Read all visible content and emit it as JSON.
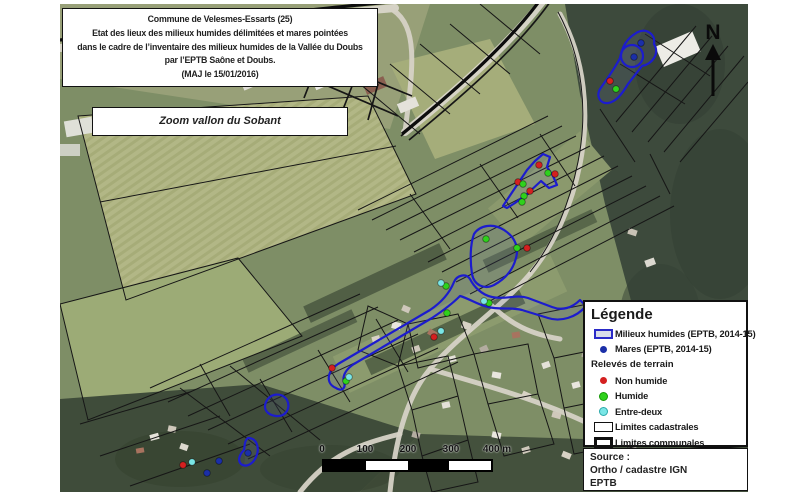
{
  "title_box": {
    "lines": [
      "Commune de Velesmes-Essarts (25)",
      "Etat des lieux des milieux humides délimitées et mares pointées",
      "dans le cadre de l’inventaire des milieux humides de la Vallée du Doubs",
      "par l’EPTB Saône et Doubs.",
      "(MAJ le 15/01/2016)"
    ]
  },
  "zoom_box": {
    "label": "Zoom vallon du Sobant"
  },
  "north_arrow": {
    "label": "N"
  },
  "scale_bar": {
    "tick_labels": [
      "0",
      "100",
      "200",
      "300",
      "400 m"
    ]
  },
  "legend": {
    "title": "Légende",
    "subheading": "Relevés de terrain",
    "items": [
      {
        "id": "milieux-humides",
        "label": "Milieux humides (EPTB, 2014-15)"
      },
      {
        "id": "mares",
        "label": "Mares (EPTB, 2014-15)"
      },
      {
        "id": "non-humide",
        "label": "Non humide"
      },
      {
        "id": "humide",
        "label": "Humide"
      },
      {
        "id": "entre-deux",
        "label": "Entre-deux"
      },
      {
        "id": "limites-cadastrales",
        "label": "Limites cadastrales"
      },
      {
        "id": "limites-communales",
        "label": "Limites communales"
      }
    ]
  },
  "source_box": {
    "lines": [
      "Source :",
      "Ortho / cadastre IGN",
      "EPTB"
    ]
  },
  "colors": {
    "mare": "#1b2fa8",
    "non_humide": "#d42020",
    "humide": "#2fd11c",
    "entre_deux": "#7ae6e6",
    "wetland_outline": "#1c1ccd",
    "cadastral_line": "#161616"
  },
  "map": {
    "wetlands": [
      {
        "name": "wetland-top-right",
        "path": "M578,28 C586,24 596,30 594,40 C600,50 592,60 582,62 L568,80 C562,90 556,98 548,99 C540,100 536,92 540,85 C546,76 554,66 560,54 C562,44 566,34 578,28 Z"
      },
      {
        "name": "wetland-top-right-ring",
        "path": "M561,52 a11,11 0 1 0 22,0 a11,11 0 1 0 -22,0"
      },
      {
        "name": "wetland-wedge",
        "path": "M443,202 L451,190 L459,178 L467,166 L475,157 L483,150 L490,153 L487,163 L493,172 L497,181 L489,184 L481,177 L467,190 L455,199 L447,204 Z"
      },
      {
        "name": "wetland-blob-mid",
        "path": "M414,230 C420,221 433,219 444,226 C455,233 459,243 456,254 C453,266 445,275 434,281 C424,286 414,281 412,270 C410,257 410,241 414,230 Z"
      },
      {
        "name": "wetland-vallon-ribbon",
        "path": "M276,384 C266,380 266,368 278,360 L370,306 C382,298 390,288 394,278 C397,271 406,269 410,275 C414,283 422,291 432,293 C446,296 456,290 468,294 L492,303 C502,307 512,304 520,296 L526,302 C516,314 500,318 488,314 L462,306 C450,303 440,306 428,303 C418,301 408,294 400,292 C394,298 384,306 372,314 L294,360 C286,365 282,372 284,378 C286,384 282,388 276,384 Z"
      },
      {
        "name": "wetland-small-blob",
        "path": "M206,398 C210,389 222,388 227,396 C231,404 226,413 216,412 C207,411 203,405 206,398 Z"
      },
      {
        "name": "wetland-comma",
        "path": "M188,434 C197,434 200,444 196,453 C193,460 186,464 181,460 C177,456 180,450 184,446 C185,442 184,437 188,434 Z"
      }
    ],
    "points": [
      {
        "type": "mare",
        "x": 581,
        "y": 39
      },
      {
        "type": "mare",
        "x": 574,
        "y": 53
      },
      {
        "type": "mare",
        "x": 159,
        "y": 457
      },
      {
        "type": "mare",
        "x": 147,
        "y": 469
      },
      {
        "type": "mare",
        "x": 188,
        "y": 449
      },
      {
        "type": "non_humide",
        "x": 550,
        "y": 77
      },
      {
        "type": "non_humide",
        "x": 479,
        "y": 161
      },
      {
        "type": "non_humide",
        "x": 495,
        "y": 170
      },
      {
        "type": "non_humide",
        "x": 458,
        "y": 178
      },
      {
        "type": "non_humide",
        "x": 470,
        "y": 187
      },
      {
        "type": "non_humide",
        "x": 374,
        "y": 333
      },
      {
        "type": "non_humide",
        "x": 272,
        "y": 364
      },
      {
        "type": "non_humide",
        "x": 123,
        "y": 461
      },
      {
        "type": "non_humide",
        "x": 467,
        "y": 244
      },
      {
        "type": "humide",
        "x": 556,
        "y": 85
      },
      {
        "type": "humide",
        "x": 488,
        "y": 169
      },
      {
        "type": "humide",
        "x": 463,
        "y": 180
      },
      {
        "type": "humide",
        "x": 464,
        "y": 192
      },
      {
        "type": "humide",
        "x": 462,
        "y": 198
      },
      {
        "type": "humide",
        "x": 386,
        "y": 282
      },
      {
        "type": "humide",
        "x": 429,
        "y": 299
      },
      {
        "type": "humide",
        "x": 387,
        "y": 309
      },
      {
        "type": "humide",
        "x": 286,
        "y": 377
      },
      {
        "type": "humide",
        "x": 426,
        "y": 235
      },
      {
        "type": "humide",
        "x": 457,
        "y": 244
      },
      {
        "type": "entre_deux",
        "x": 381,
        "y": 279
      },
      {
        "type": "entre_deux",
        "x": 424,
        "y": 297
      },
      {
        "type": "entre_deux",
        "x": 381,
        "y": 327
      },
      {
        "type": "entre_deux",
        "x": 289,
        "y": 373
      },
      {
        "type": "entre_deux",
        "x": 132,
        "y": 458
      }
    ]
  }
}
